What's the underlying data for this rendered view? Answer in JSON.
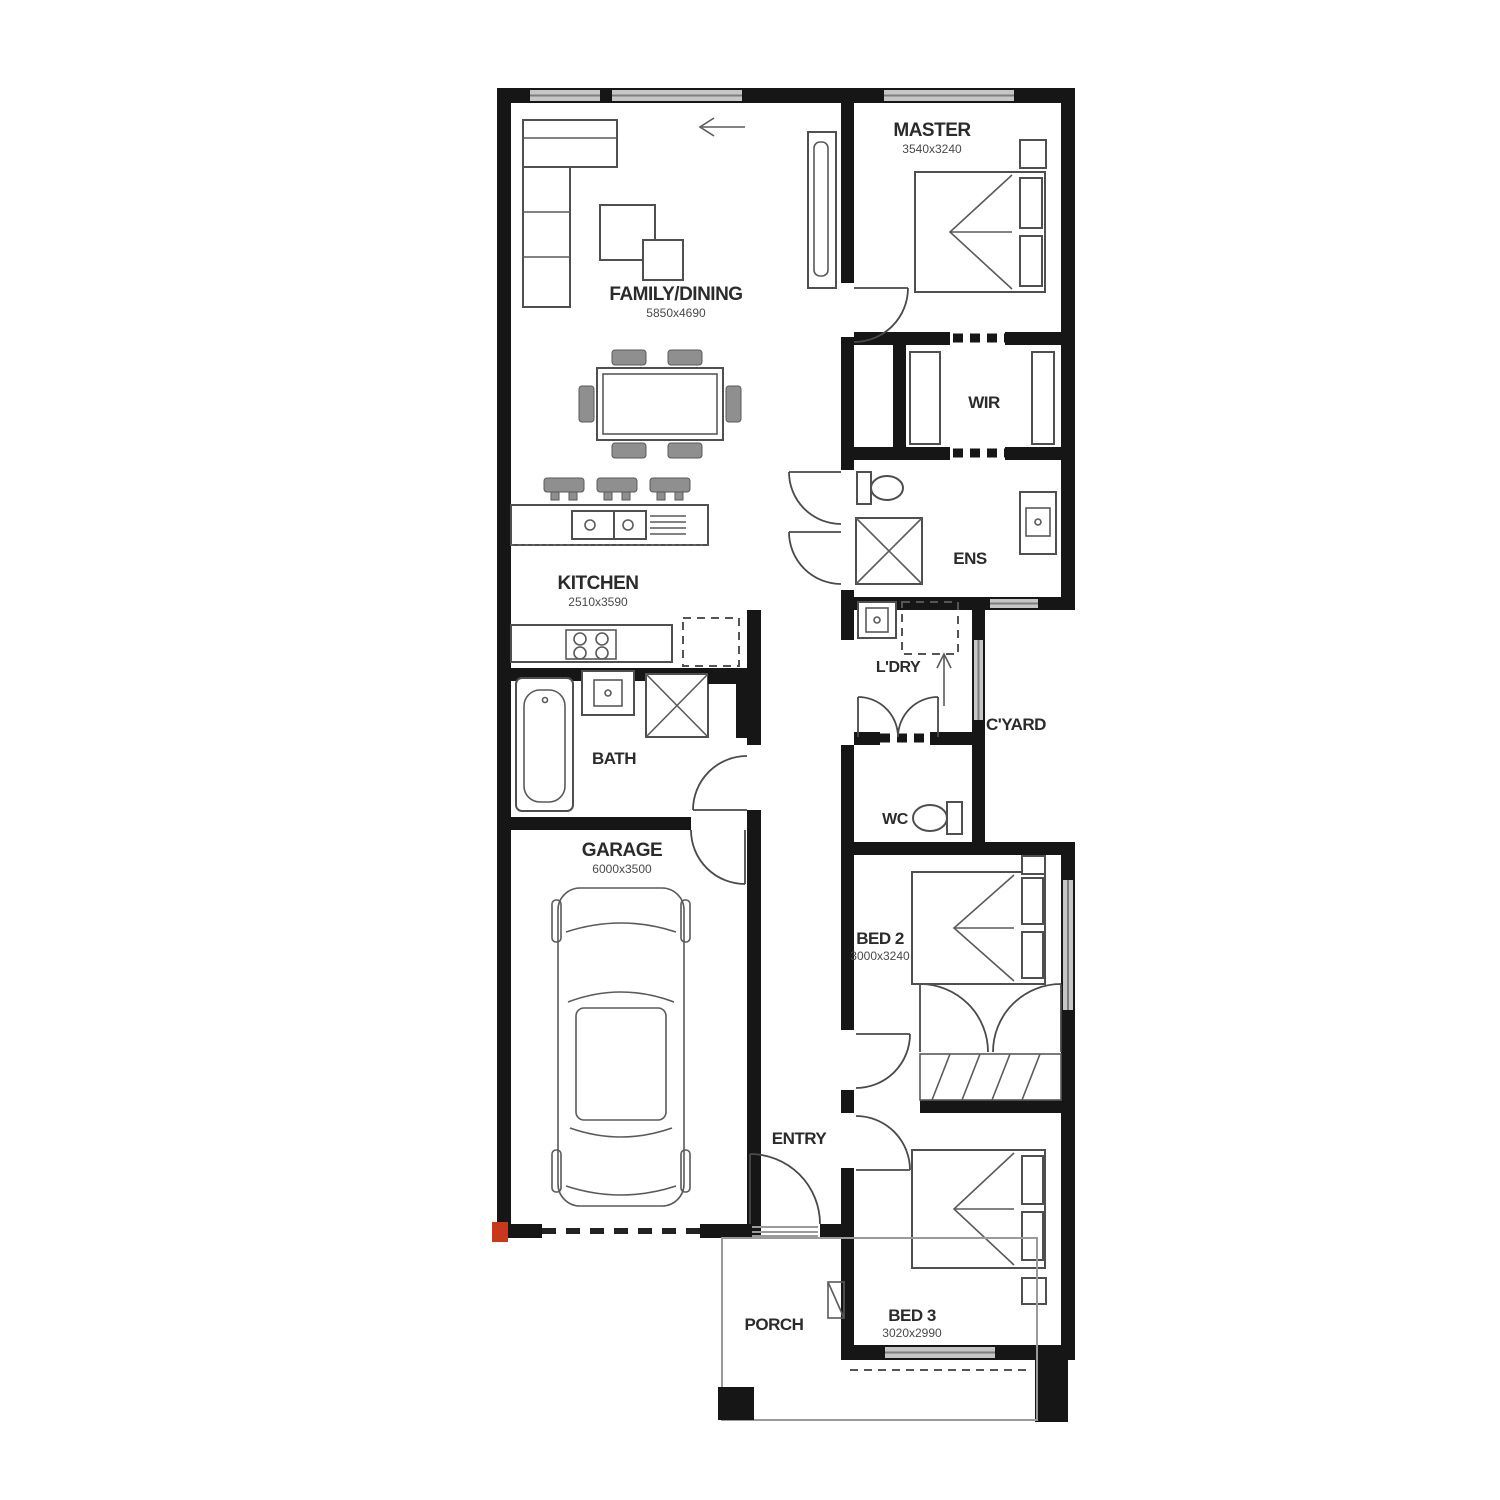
{
  "plan": {
    "title": "single-storey-house-floor-plan",
    "rooms": [
      {
        "id": "family",
        "label": "FAMILY/DINING",
        "dims": "5850x4690"
      },
      {
        "id": "master",
        "label": "MASTER",
        "dims": "3540x3240"
      },
      {
        "id": "wir",
        "label": "WIR",
        "dims": ""
      },
      {
        "id": "ens",
        "label": "ENS",
        "dims": ""
      },
      {
        "id": "kitchen",
        "label": "KITCHEN",
        "dims": "2510x3590"
      },
      {
        "id": "ldry",
        "label": "L'DRY",
        "dims": ""
      },
      {
        "id": "cyard",
        "label": "C'YARD",
        "dims": ""
      },
      {
        "id": "bath",
        "label": "BATH",
        "dims": ""
      },
      {
        "id": "wc",
        "label": "WC",
        "dims": ""
      },
      {
        "id": "garage",
        "label": "GARAGE",
        "dims": "6000x3500"
      },
      {
        "id": "bed2",
        "label": "BED 2",
        "dims": "3000x3240"
      },
      {
        "id": "entry",
        "label": "ENTRY",
        "dims": ""
      },
      {
        "id": "bed3",
        "label": "BED 3",
        "dims": "3020x2990"
      },
      {
        "id": "porch",
        "label": "PORCH",
        "dims": ""
      }
    ],
    "colors": {
      "wall": "#161616",
      "window_fill": "#c6c6c6",
      "furniture_line": "#4f4f4f",
      "chair_fill": "#8f8f8f",
      "accent_red": "#c9371d",
      "background": "#ffffff"
    }
  }
}
